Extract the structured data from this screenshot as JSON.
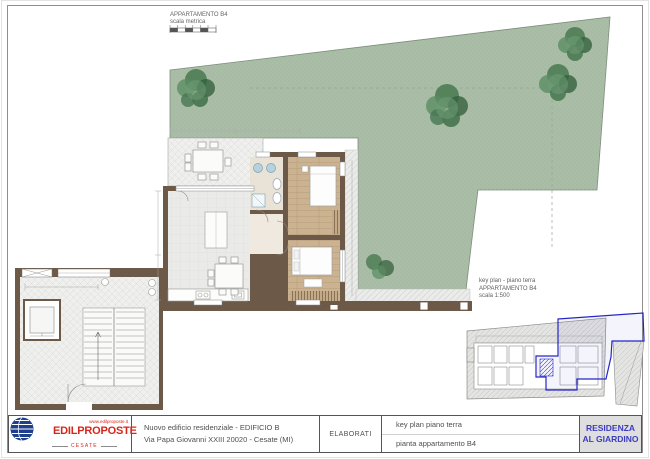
{
  "sheet": {
    "scale_legend": {
      "line1": "APPARTAMENTO B4",
      "line2": "scala metrica"
    },
    "key_plan_label": {
      "line1": "key plan - piano terra",
      "line2": "APPARTAMENTO B4",
      "line3": "scala 1:500"
    }
  },
  "title_block": {
    "logo": {
      "name": "EDILPROPOSTE",
      "website": "www.edilproposte.it",
      "city": "CESATE"
    },
    "project_line1": "Nuovo edificio residenziale - EDIFICIO B",
    "project_line2": "Via Papa Giovanni XXIII 20020 - Cesate (MI)",
    "elaborati_label": "ELABORATI",
    "elaborati_row1": "key plan piano terra",
    "elaborati_row2": "pianta appartamento B4",
    "residence_line1": "RESIDENZA",
    "residence_line2": "AL GIARDINO"
  },
  "colors": {
    "garden_green": "#a9bda7",
    "tree_green": "#3f7049",
    "wall_brown": "#6d5947",
    "wood_floor": "#cbb291",
    "logo_red": "#d5261b",
    "logo_blue": "#1e3e8e",
    "residence_blue": "#3c3cc0",
    "keyplan_highlight_blue": "#2626c9"
  }
}
